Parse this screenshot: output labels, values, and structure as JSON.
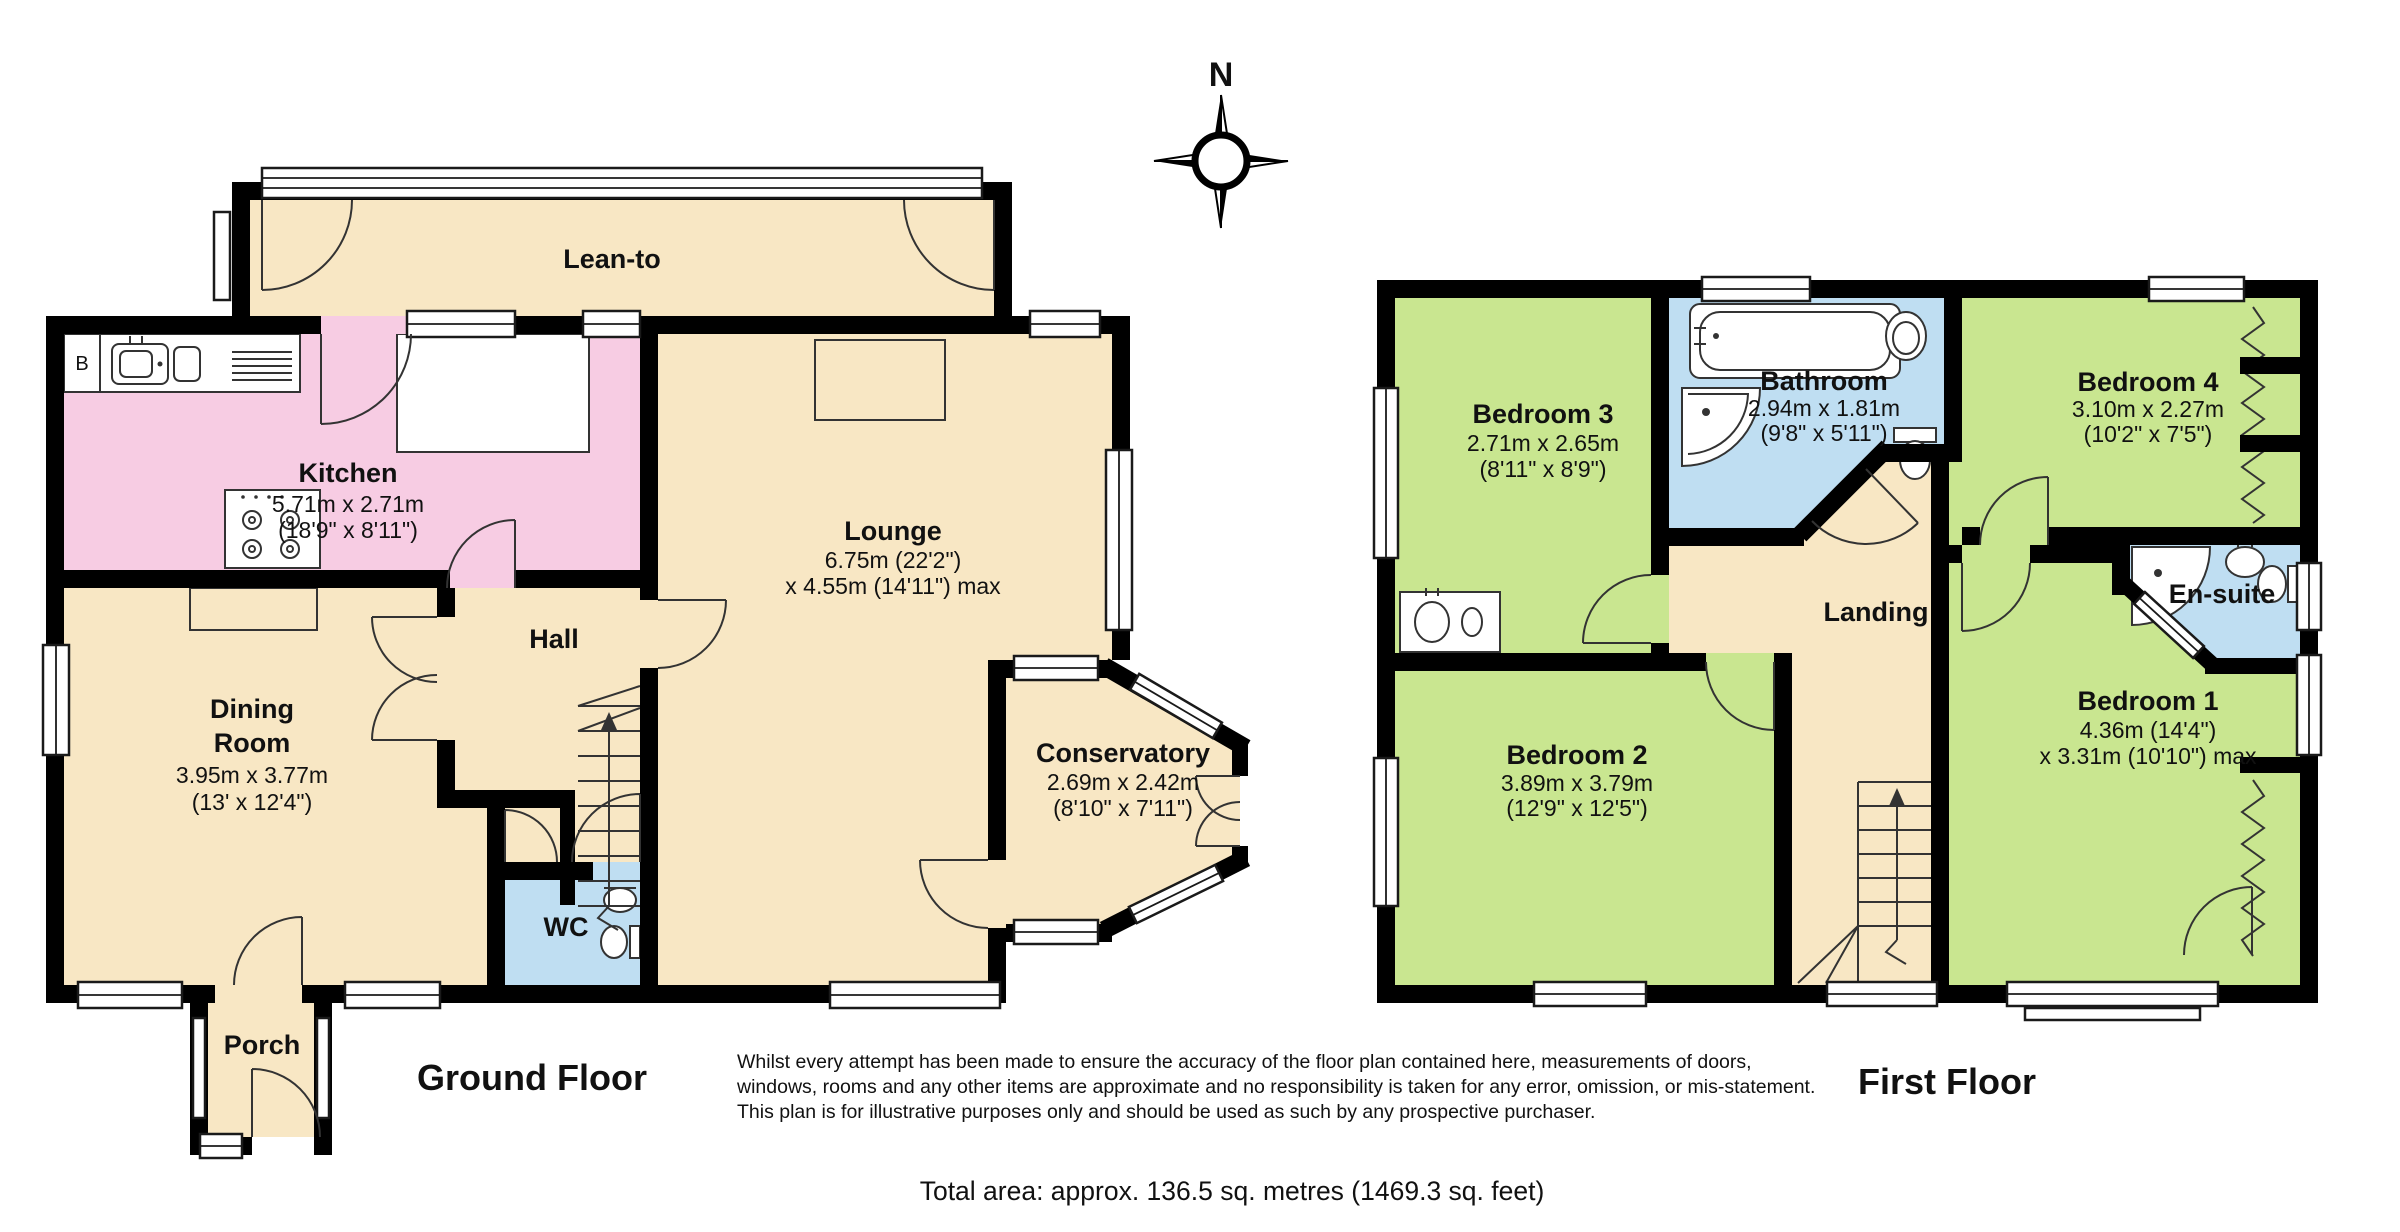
{
  "compass": {
    "north_label": "N"
  },
  "ground_floor": {
    "title": "Ground Floor",
    "boiler_label": "B",
    "rooms": [
      {
        "id": "lean-to",
        "label_lines": [
          "Lean-to"
        ]
      },
      {
        "id": "kitchen",
        "label_lines": [
          "Kitchen",
          "5.71m x 2.71m",
          "(18'9\" x 8'11\")"
        ]
      },
      {
        "id": "lounge",
        "label_lines": [
          "Lounge",
          "6.75m (22'2\")",
          "x 4.55m (14'11\") max"
        ]
      },
      {
        "id": "hall",
        "label_lines": [
          "Hall"
        ]
      },
      {
        "id": "dining-room",
        "label_lines": [
          "Dining",
          "Room",
          "3.95m x 3.77m",
          "(13' x 12'4\")"
        ]
      },
      {
        "id": "wc",
        "label_lines": [
          "WC"
        ]
      },
      {
        "id": "porch",
        "label_lines": [
          "Porch"
        ]
      },
      {
        "id": "conservatory",
        "label_lines": [
          "Conservatory",
          "2.69m x 2.42m",
          "(8'10\" x 7'11\")"
        ]
      }
    ]
  },
  "first_floor": {
    "title": "First Floor",
    "rooms": [
      {
        "id": "bedroom-3",
        "label_lines": [
          "Bedroom 3",
          "2.71m x 2.65m",
          "(8'11\" x 8'9\")"
        ]
      },
      {
        "id": "bathroom",
        "label_lines": [
          "Bathroom",
          "2.94m x 1.81m",
          "(9'8\" x 5'11\")"
        ]
      },
      {
        "id": "bedroom-4",
        "label_lines": [
          "Bedroom 4",
          "3.10m x 2.27m",
          "(10'2\" x 7'5\")"
        ]
      },
      {
        "id": "landing",
        "label_lines": [
          "Landing"
        ]
      },
      {
        "id": "en-suite",
        "label_lines": [
          "En-suite"
        ]
      },
      {
        "id": "bedroom-2",
        "label_lines": [
          "Bedroom 2",
          "3.89m x 3.79m",
          "(12'9\" x 12'5\")"
        ]
      },
      {
        "id": "bedroom-1",
        "label_lines": [
          "Bedroom 1",
          "4.36m (14'4\")",
          "x 3.31m (10'10\") max"
        ]
      }
    ]
  },
  "footer": {
    "disclaimer_lines": [
      "Whilst every attempt has been made to ensure the accuracy of the floor plan contained here, measurements of doors,",
      "windows, rooms and any other items are approximate and no responsibility is taken for any error, omission, or mis-statement.",
      "This plan is for illustrative purposes only and should be used as such by any prospective purchaser."
    ],
    "total_area": "Total area: approx. 136.5 sq. metres (1469.3 sq. feet)"
  },
  "colors": {
    "room_beige": "#F8E7C4",
    "room_pink": "#F7CCE3",
    "room_green": "#C9E690",
    "room_blue": "#BFDEF2",
    "wall_black": "#000000"
  }
}
